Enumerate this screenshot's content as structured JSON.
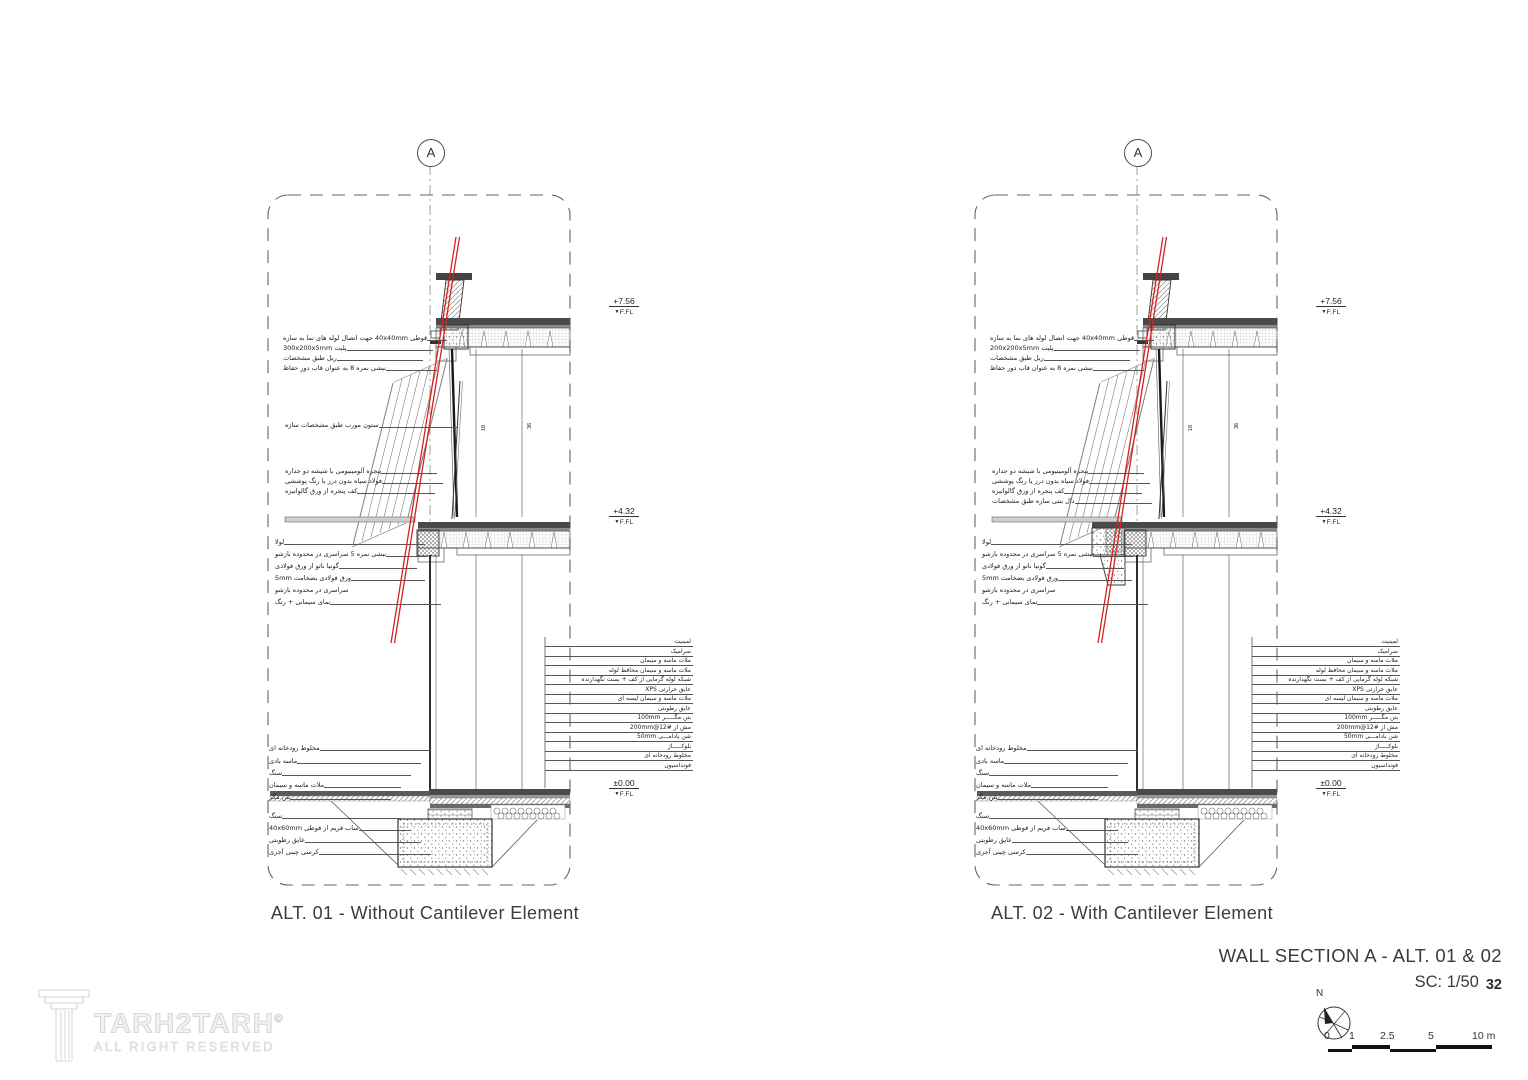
{
  "title_block": {
    "title": "WALL SECTION A - ALT. 01 & 02",
    "scale": "SC: 1/50",
    "page_number": "32",
    "north_label": "N",
    "scale_bar_labels": [
      "0",
      "1",
      "2.5",
      "5",
      "10 m"
    ]
  },
  "logo": {
    "name": "TARH2TARH",
    "mark": "©",
    "subtitle": "ALL RIGHT RESERVED"
  },
  "colors": {
    "line": "#3a3a3a",
    "section_cut": "#d42222",
    "watermark": "#e9e9e9"
  },
  "panels": [
    {
      "variant": "without-cantilever",
      "caption": "ALT. 01 - Without Cantilever Element",
      "section_marker": "A",
      "elevations": [
        {
          "value": "+7.56",
          "datum": "F.FL"
        },
        {
          "value": "+4.32",
          "datum": "F.FL"
        },
        {
          "value": "±0.00",
          "datum": "F.FL"
        }
      ],
      "top_labels": [
        "قوطی 40x40mm جهت اتصال لوله های نما به سازه",
        "پلیت 300x200x5mm",
        "ریل طبق مشخصات",
        "نبشی نمره 8 به عنوان قاب دور حفاظ"
      ],
      "column_label": "ستون مورب طبق مشخصات سازه",
      "window_labels": [
        "پنجره آلومینیومی با شیشه دو جداره",
        "فولاد سیاه بدون درز با رنگ پوششی",
        "کف پنجره از ورق گالوانیزه"
      ],
      "hinge_labels": [
        "لولا",
        "نبشی نمره 5 سراسری در محدوده بازشو",
        "گونیا ناتو از ورق فولادی",
        "ورق فولادی بضخامت 5mm",
        "سراسری در محدوده بازشو",
        "نمای سیمانی + رنگ"
      ],
      "floor_assembly": [
        "لمینیت",
        "سرامیک",
        "ملات ماسه و سیمان",
        "ملات ماسه و سیمان محافظ لوله",
        "شبکه لوله گرمایی از کف + بست نگهدارنده",
        "عایق حرارتی XPS",
        "ملات ماسه و سیمان لیسه ای",
        "عایق رطوبتی",
        "بتن مگـــــر 100mm",
        "مش از #12@200mm",
        "شن بادامـــی 50mm",
        "بلوکـــــاژ",
        "مخلوط رودخانه ای",
        "فونداسیون"
      ],
      "ground_labels": [
        "مخلوط رودخانه ای",
        "ماسه بادی",
        "سنگ",
        "ملات ماسه و سیمان",
        "بتن مگر"
      ],
      "foundation_labels": [
        "سنگ",
        "ساب فریم از قوطی 40x60mm",
        "عایق رطوبتی",
        "کرسی چینی آجری"
      ],
      "dim_labels": [
        "18",
        "36"
      ]
    },
    {
      "variant": "with-cantilever",
      "caption": "ALT. 02 - With Cantilever Element",
      "section_marker": "A",
      "elevations": [
        {
          "value": "+7.56",
          "datum": "F.FL"
        },
        {
          "value": "+4.32",
          "datum": "F.FL"
        },
        {
          "value": "±0.00",
          "datum": "F.FL"
        }
      ],
      "top_labels": [
        "قوطی 40x40mm جهت اتصال لوله های نما به سازه",
        "پلیت 200x200x5mm",
        "ریل طبق مشخصات",
        "نبشی نمره 8 به عنوان قاب دور حفاظ"
      ],
      "column_label": "",
      "window_labels": [
        "پنجره آلومینیومی با شیشه دو جداره",
        "فولاد سیاه بدون درز یا رنگ پوششی",
        "کف پنجره از ورق گالوانیزه",
        "دال بتنی سازه طبق مشخصات"
      ],
      "hinge_labels": [
        "لولا",
        "نبشی نمره 5 سراسری در محدوده بازشو",
        "گونیا ناتو از ورق فولادی",
        "ورق فولادی بضخامت 5mm",
        "سراسری در محدوده بازشو",
        "نمای سیمانی + رنگ"
      ],
      "floor_assembly": [
        "لمینیت",
        "سرامیک",
        "ملات ماسه و سیمان",
        "ملات ماسه و سیمان محافظ لوله",
        "شبکه لوله گرمایی از کف + بست نگهدارنده",
        "عایق حرارتی XPS",
        "ملات ماسه و سیمان لیسه ای",
        "عایق رطوبتی",
        "بتن مگـــــر 100mm",
        "مش از #12@200mm",
        "شن بادامـــی 50mm",
        "بلوکـــــاژ",
        "مخلوط رودخانه ای",
        "فونداسیون"
      ],
      "ground_labels": [
        "مخلوط رودخانه ای",
        "ماسه بادی",
        "سنگ",
        "ملات ماسه و سیمان",
        "بتن مگر"
      ],
      "foundation_labels": [
        "سنگ",
        "ساب فریم از قوطی 40x60mm",
        "عایق رطوبتی",
        "کرسی چینی آجری"
      ],
      "dim_labels": [
        "18",
        "36"
      ]
    }
  ]
}
